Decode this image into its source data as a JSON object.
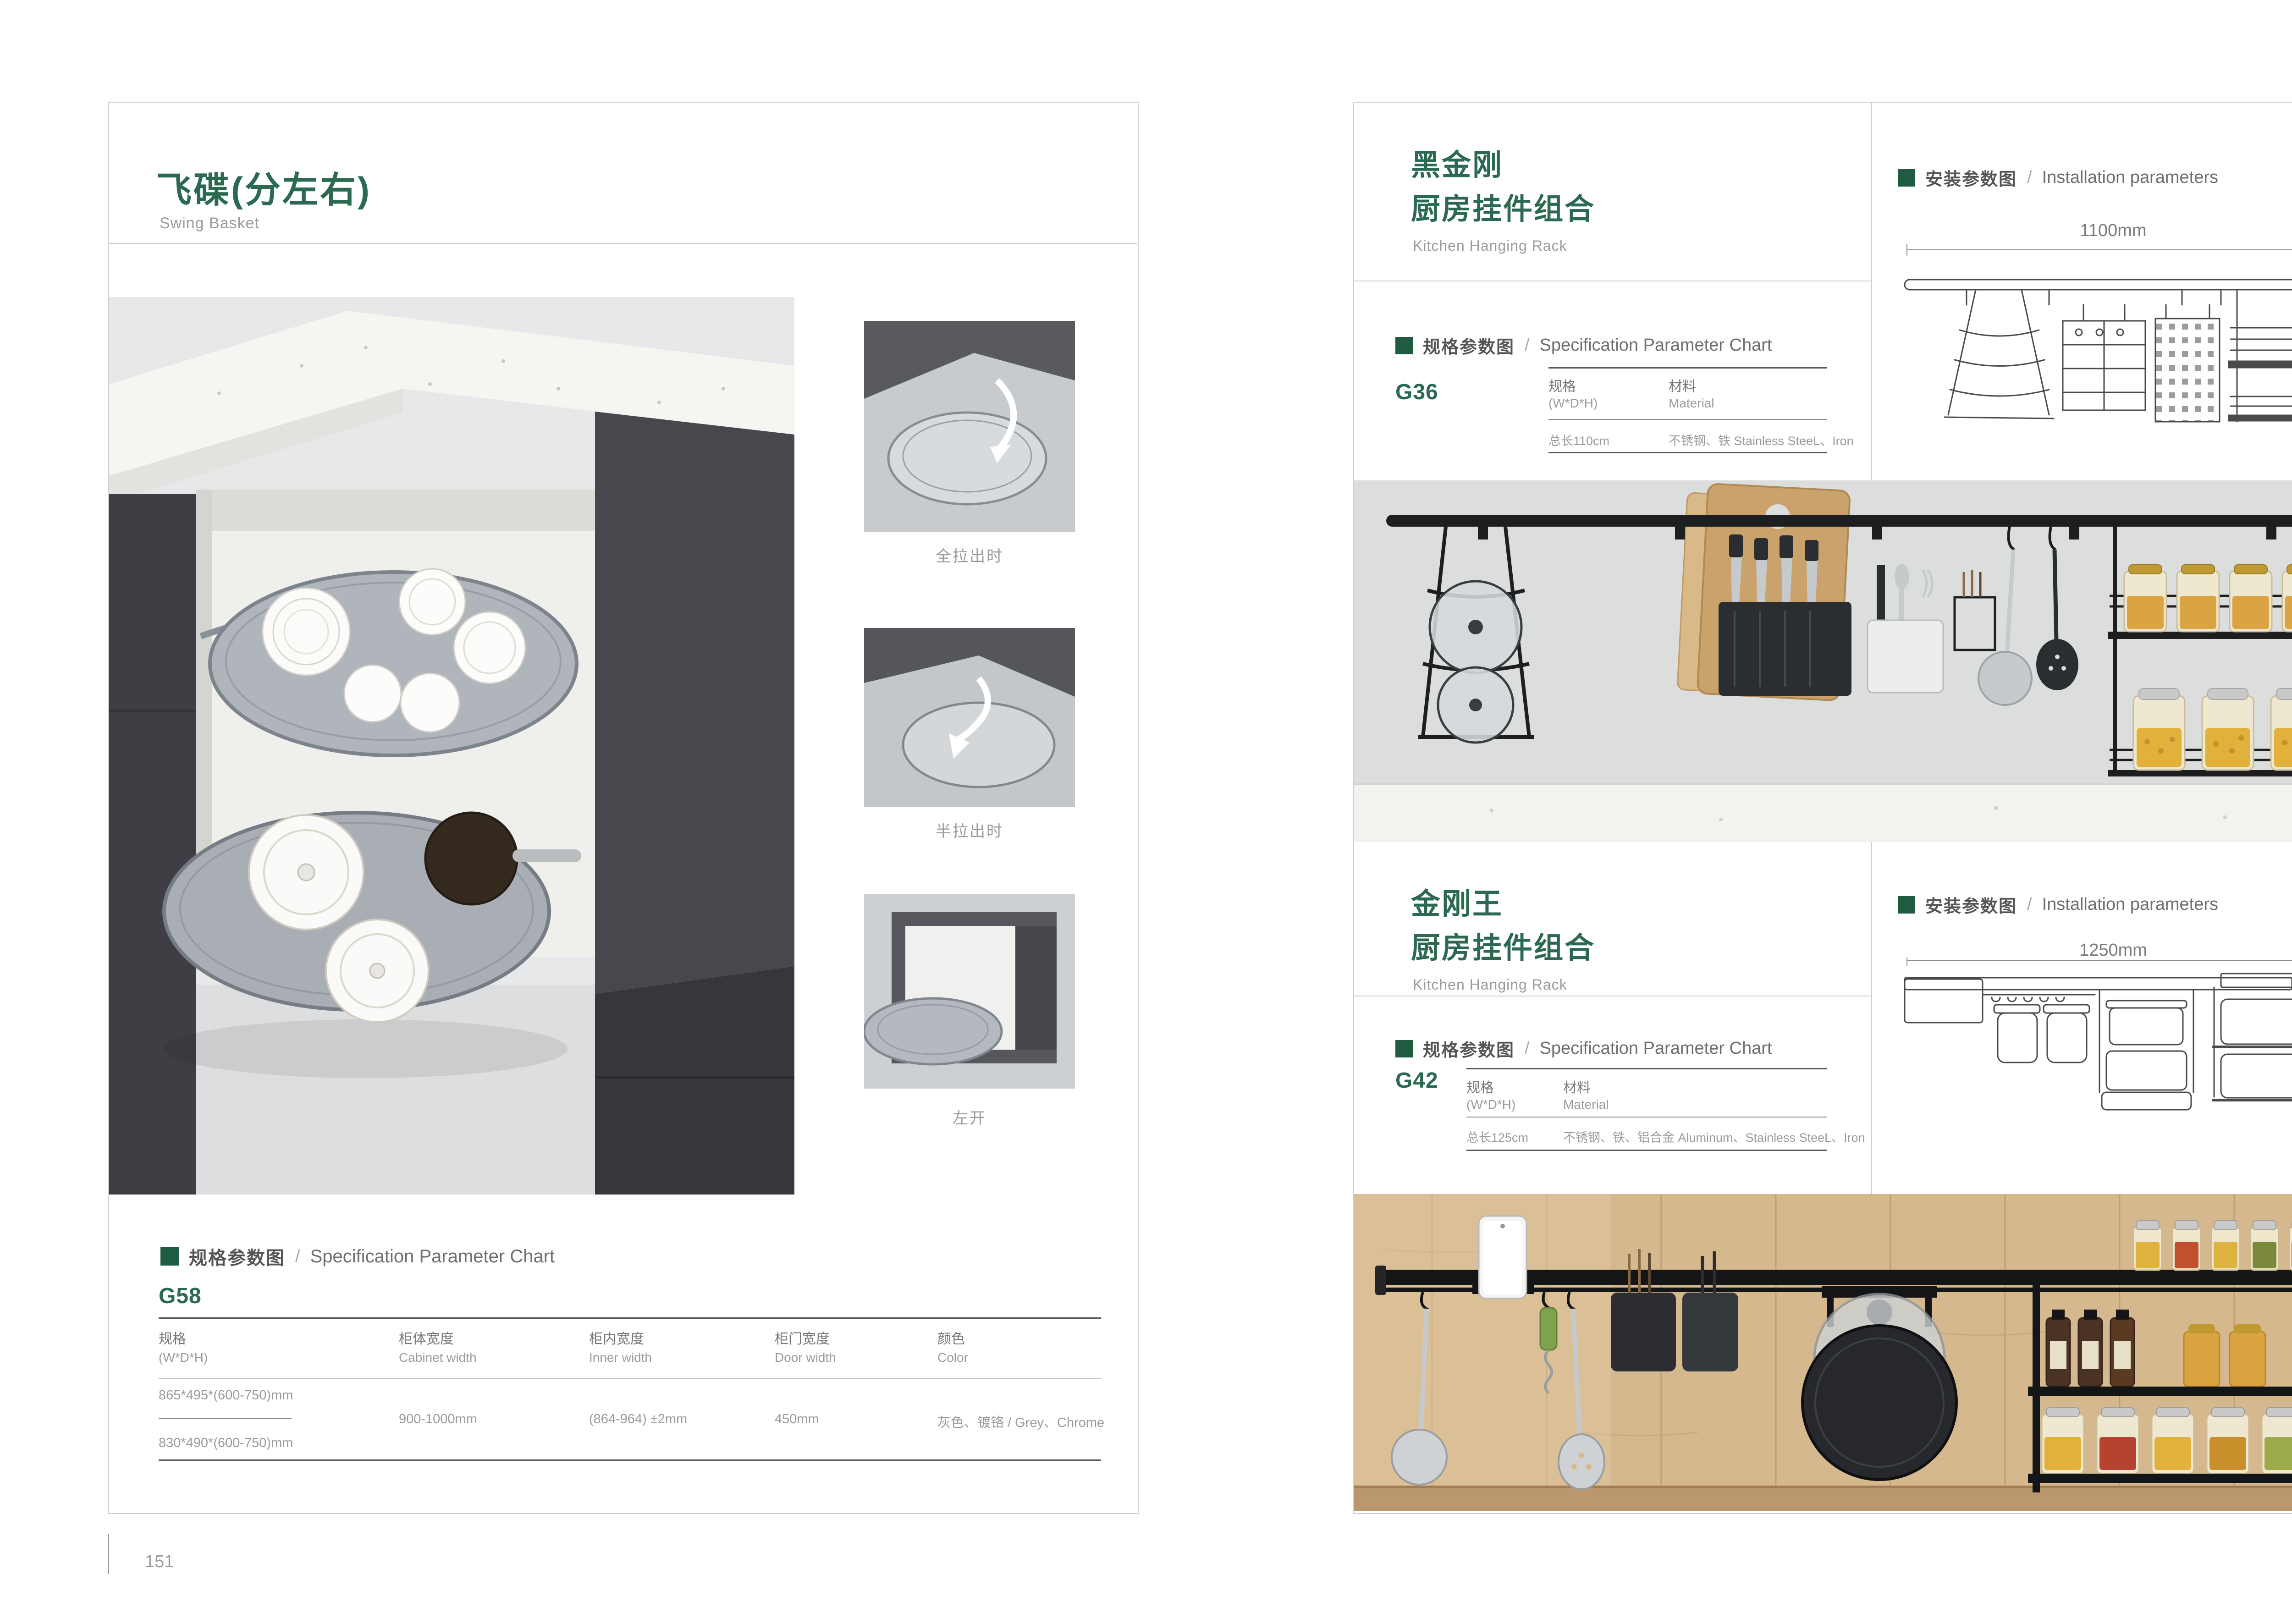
{
  "colors": {
    "accent_green": "#2b6a50",
    "bullet_green": "#1e5b41",
    "text_gray": "#9b9b9b",
    "text_dark": "#555555"
  },
  "left_page": {
    "title": "飞碟(分左右)",
    "subtitle": "Swing Basket",
    "spec_header": {
      "zh": "规格参数图",
      "divider": "/",
      "en": "Specification Parameter Chart"
    },
    "model": "G58",
    "spec_table": {
      "columns": [
        {
          "zh": "规格",
          "en": "(W*D*H)"
        },
        {
          "zh": "柜体宽度",
          "en": "Cabinet width"
        },
        {
          "zh": "柜内宽度",
          "en": "Inner width"
        },
        {
          "zh": "柜门宽度",
          "en": "Door width"
        },
        {
          "zh": "颜色",
          "en": "Color"
        }
      ],
      "spec_row_1": "865*495*(600-750)mm",
      "spec_row_2": "830*490*(600-750)mm",
      "cabinet_width": "900-1000mm",
      "inner_width": "(864-964) ±2mm",
      "door_width": "450mm",
      "color": "灰色、镀铬 / Grey、Chrome"
    },
    "thumb_captions": {
      "full": "全拉出时",
      "half": "半拉出时",
      "left_open": "左开"
    },
    "page_number": "151"
  },
  "right_page": {
    "sections": [
      {
        "title_line1": "黑金刚",
        "title_line2": "厨房挂件组合",
        "subtitle": "Kitchen Hanging Rack",
        "model": "G36",
        "spec_header": {
          "zh": "规格参数图",
          "divider": "/",
          "en": "Specification Parameter Chart"
        },
        "install_header": {
          "zh": "安装参数图",
          "divider": "/",
          "en": "Installation parameters"
        },
        "table": {
          "col1_zh": "规格",
          "col1_en": "(W*D*H)",
          "col2_zh": "材料",
          "col2_en": "Material",
          "spec_value": "总长110cm",
          "material_value": "不锈钢、铁 Stainless SteeL、Iron"
        },
        "dims": {
          "width": "1100mm",
          "height": "420mm"
        }
      },
      {
        "title_line1": "金刚王",
        "title_line2": "厨房挂件组合",
        "subtitle": "Kitchen Hanging Rack",
        "model": "G42",
        "spec_header": {
          "zh": "规格参数图",
          "divider": "/",
          "en": "Specification Parameter Chart"
        },
        "install_header": {
          "zh": "安装参数图",
          "divider": "/",
          "en": "Installation parameters"
        },
        "table": {
          "col1_zh": "规格",
          "col1_en": "(W*D*H)",
          "col2_zh": "材料",
          "col2_en": "Material",
          "spec_value": "总长125cm",
          "material_value": "不锈钢、铁、铝合金 Aluminum、Stainless SteeL、Iron"
        },
        "dims": {
          "width": "1250mm",
          "height": "430mm"
        }
      }
    ],
    "page_number": "152"
  }
}
